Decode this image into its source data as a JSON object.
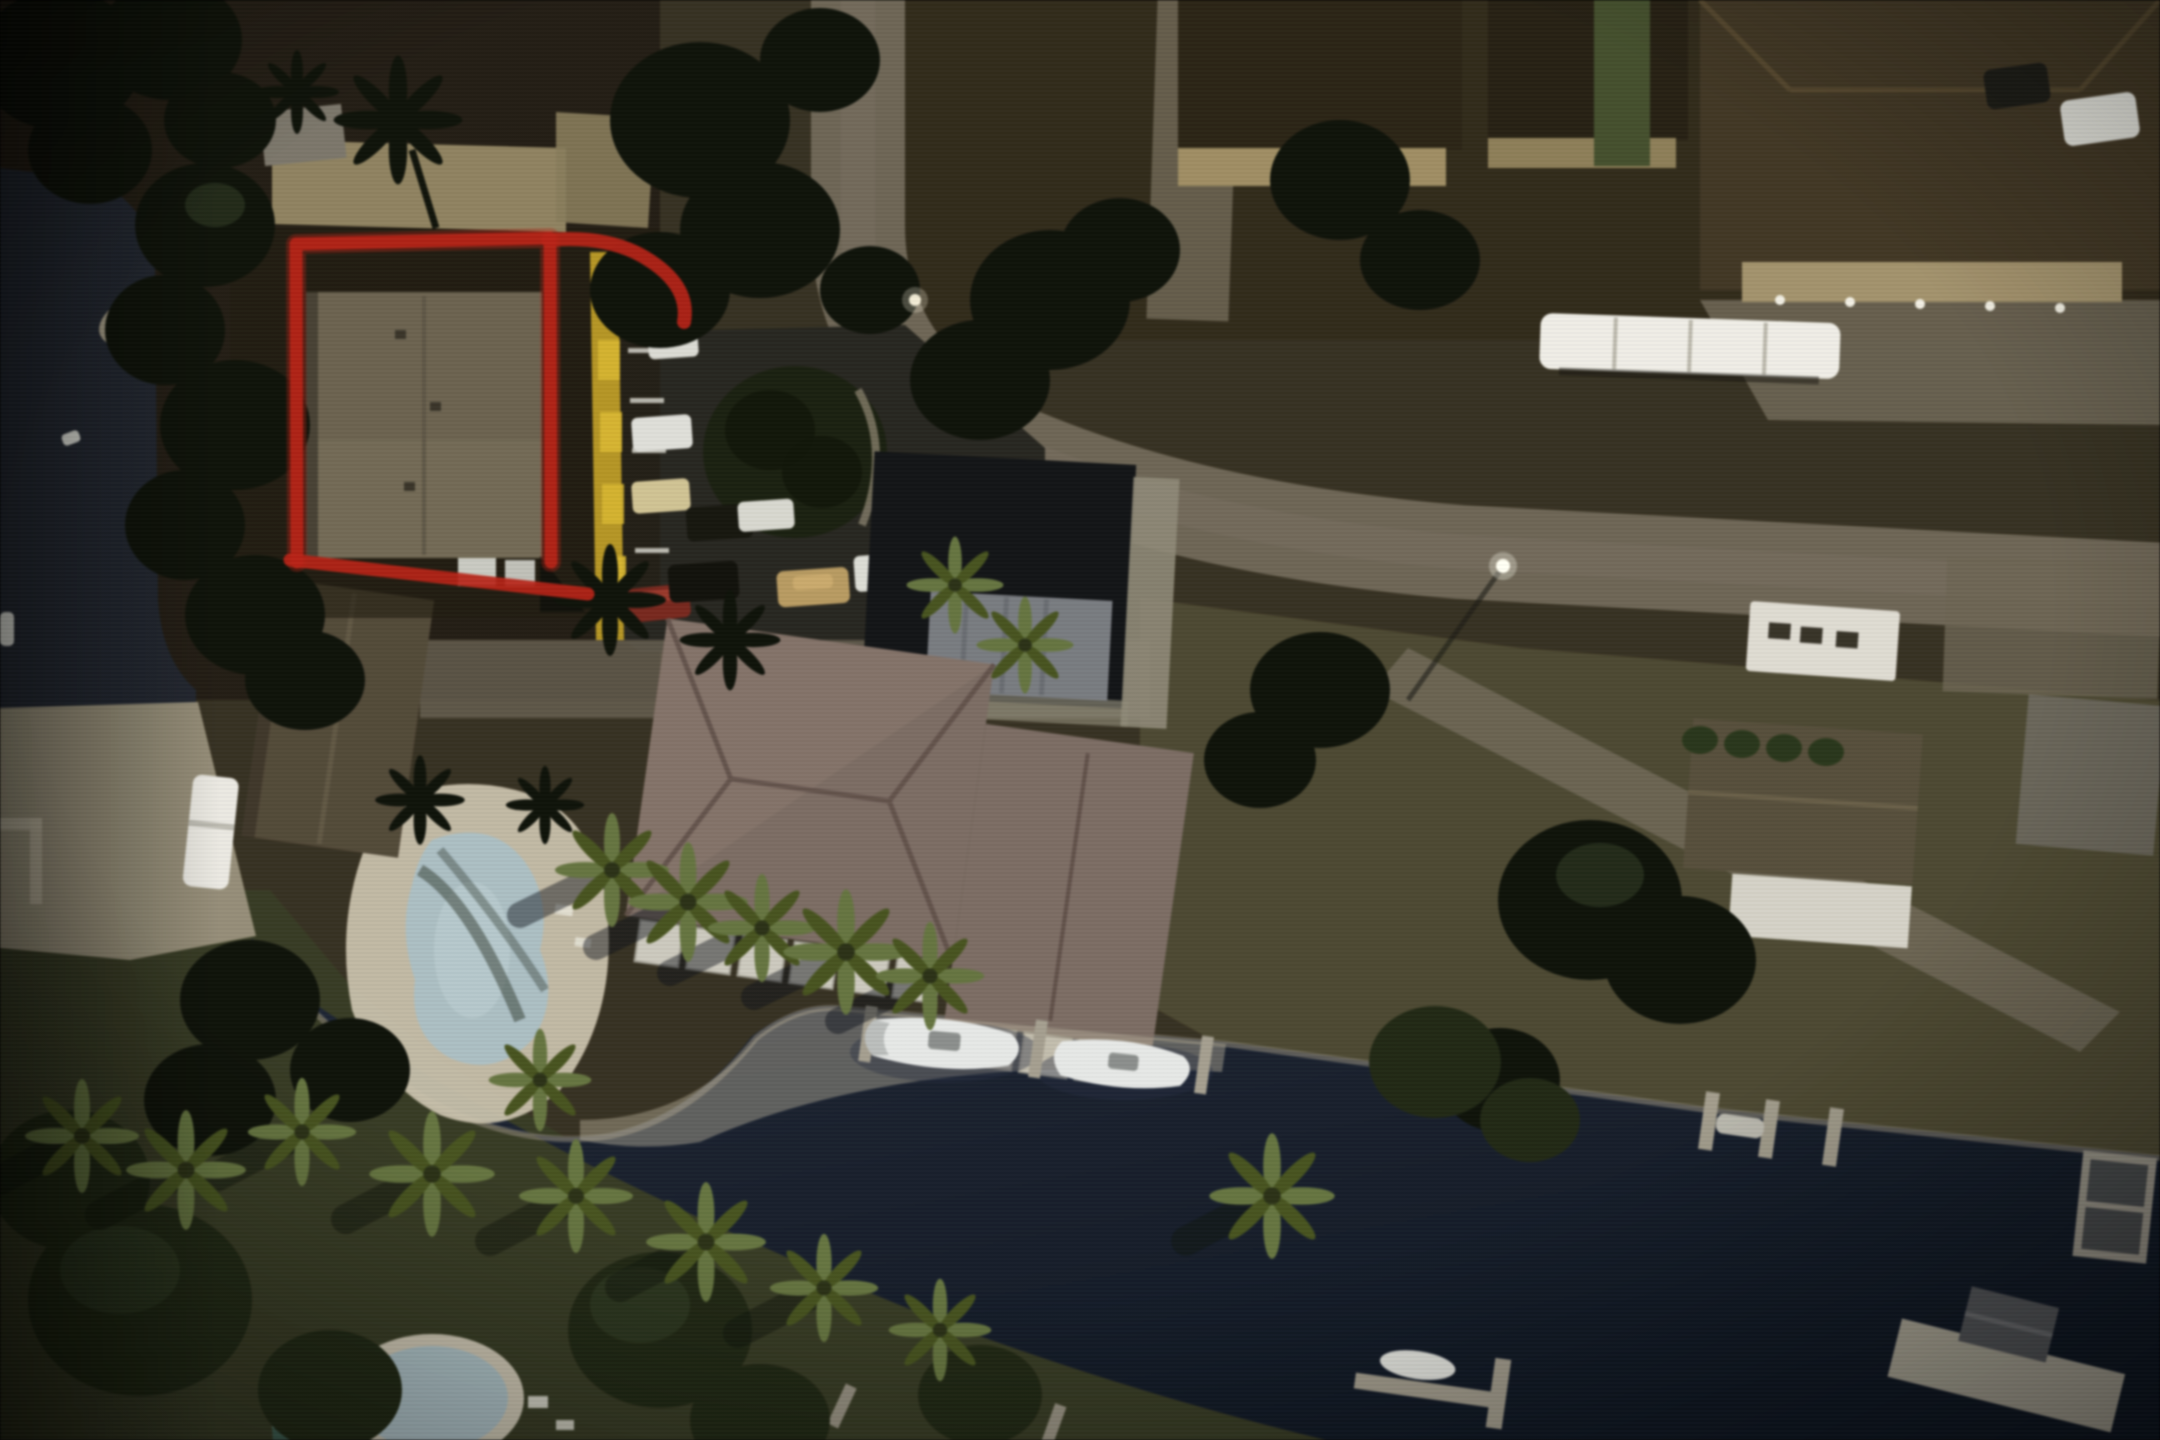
{
  "meta": {
    "kind": "aerial-photograph",
    "description": "Night-time aerial/satellite photo of a waterfront canal neighborhood. A long flat-roofed condo building at upper left is highlighted with a hand-drawn red outline that has a curved tail at its top-right corner. A yellow curb strip and parking lot with cars sit beside it. A large mauve hip-roofed clubhouse with white screened lanais faces a dark canal where two white boats are docked at a seawall. Kidney-shaped pool on a point of land, second pool at bottom edge, rows of lit palm trees along the banks, curving paver road with houses, a long white trailer, docks and a boat lift at bottom right.",
    "time_of_day": "night",
    "visible_text": ""
  },
  "annotation": {
    "name": "highlighted-property-outline",
    "shape": "rectangle with curved tail stroke at top-right and sloped base line",
    "purpose": "marks the subject building/parcel",
    "color": "#bf2417"
  },
  "colors": {
    "land_base": "#3a3424",
    "water": "#1a2230",
    "water_left": "#262b34",
    "lawn_east": "#4f4b33",
    "lawn_south": "#3a3e26",
    "road": "#6f6756",
    "pavement": "#6e6654",
    "asphalt": "#2b2a23",
    "pool_deck": "#c7bfa9",
    "pool_water": "#a9bdc2",
    "roof_tan": "#6d6450",
    "roof_pink": "#7d6d64",
    "roof_gray": "#554c3a",
    "wall_tan": "#91835f",
    "yellow_curb": "#b6951f",
    "outline_red": "#bf2417",
    "court_dark": "#16181a",
    "pergola_gray": "#7e8287",
    "white_struct": "#d9dad2",
    "boat_white": "#e3e5e3",
    "tree_dark": "#12160d",
    "tree_green": "#242c17",
    "seawall": "#8a8474",
    "patio": "#968e77",
    "trailer_white": "#eceae2",
    "hedge_green": "#46522e",
    "teal_shed": "#3f5f52",
    "mobile_home": "#ddd9cf",
    "palm_lit": "#66763f",
    "palm_lit_dark": "#49561f",
    "dock_gray": "#a29c8b",
    "shadow_dark": "#15190f"
  },
  "objects": {
    "highlighted_building": "long flat tan-roofed condo inside red outline",
    "second_condo": "gray gable-roof building below highlighted one",
    "clubhouse": "large mauve hip-roof building with white screened lanais by canal",
    "sport_court": "dark rectangular court with gray pergola structure",
    "pools": [
      "kidney pool on point of land",
      "partial pool at bottom edge"
    ],
    "boats": [
      "white boat at condo seawall 1",
      "white boat at condo seawall 2",
      "small white boat left canal",
      "boat at L-dock bottom"
    ],
    "vehicles": [
      "white van",
      "cream sedan",
      "red sedan",
      "white car at curb",
      "tan sedan",
      "white pickup",
      "dark SUVs (3)",
      "white car top-right",
      "dark car top-right",
      "long white trailer-RV",
      "white RV/boat near patio"
    ],
    "docks": [
      "finger piers at east bank (3)",
      "boat lift at right edge",
      "large dock with gray boathouse bottom-right",
      "L-dock with boat",
      "small piers bottom center"
    ],
    "houses": [
      "houses with dark roofs along top",
      "large hip-roof house top-right",
      "house north of road with porch",
      "white mobile home south of road",
      "gray gable house east lawn",
      "light house far right"
    ],
    "landscape": [
      "canal water",
      "left canal arm",
      "rows of lit palm trees (~18)",
      "dense dark tree canopies",
      "teardrop island in parking lot",
      "green hedge",
      "lawns"
    ],
    "road": "paver road entering at top center, curving east to right edge, with branch lane to canal"
  }
}
